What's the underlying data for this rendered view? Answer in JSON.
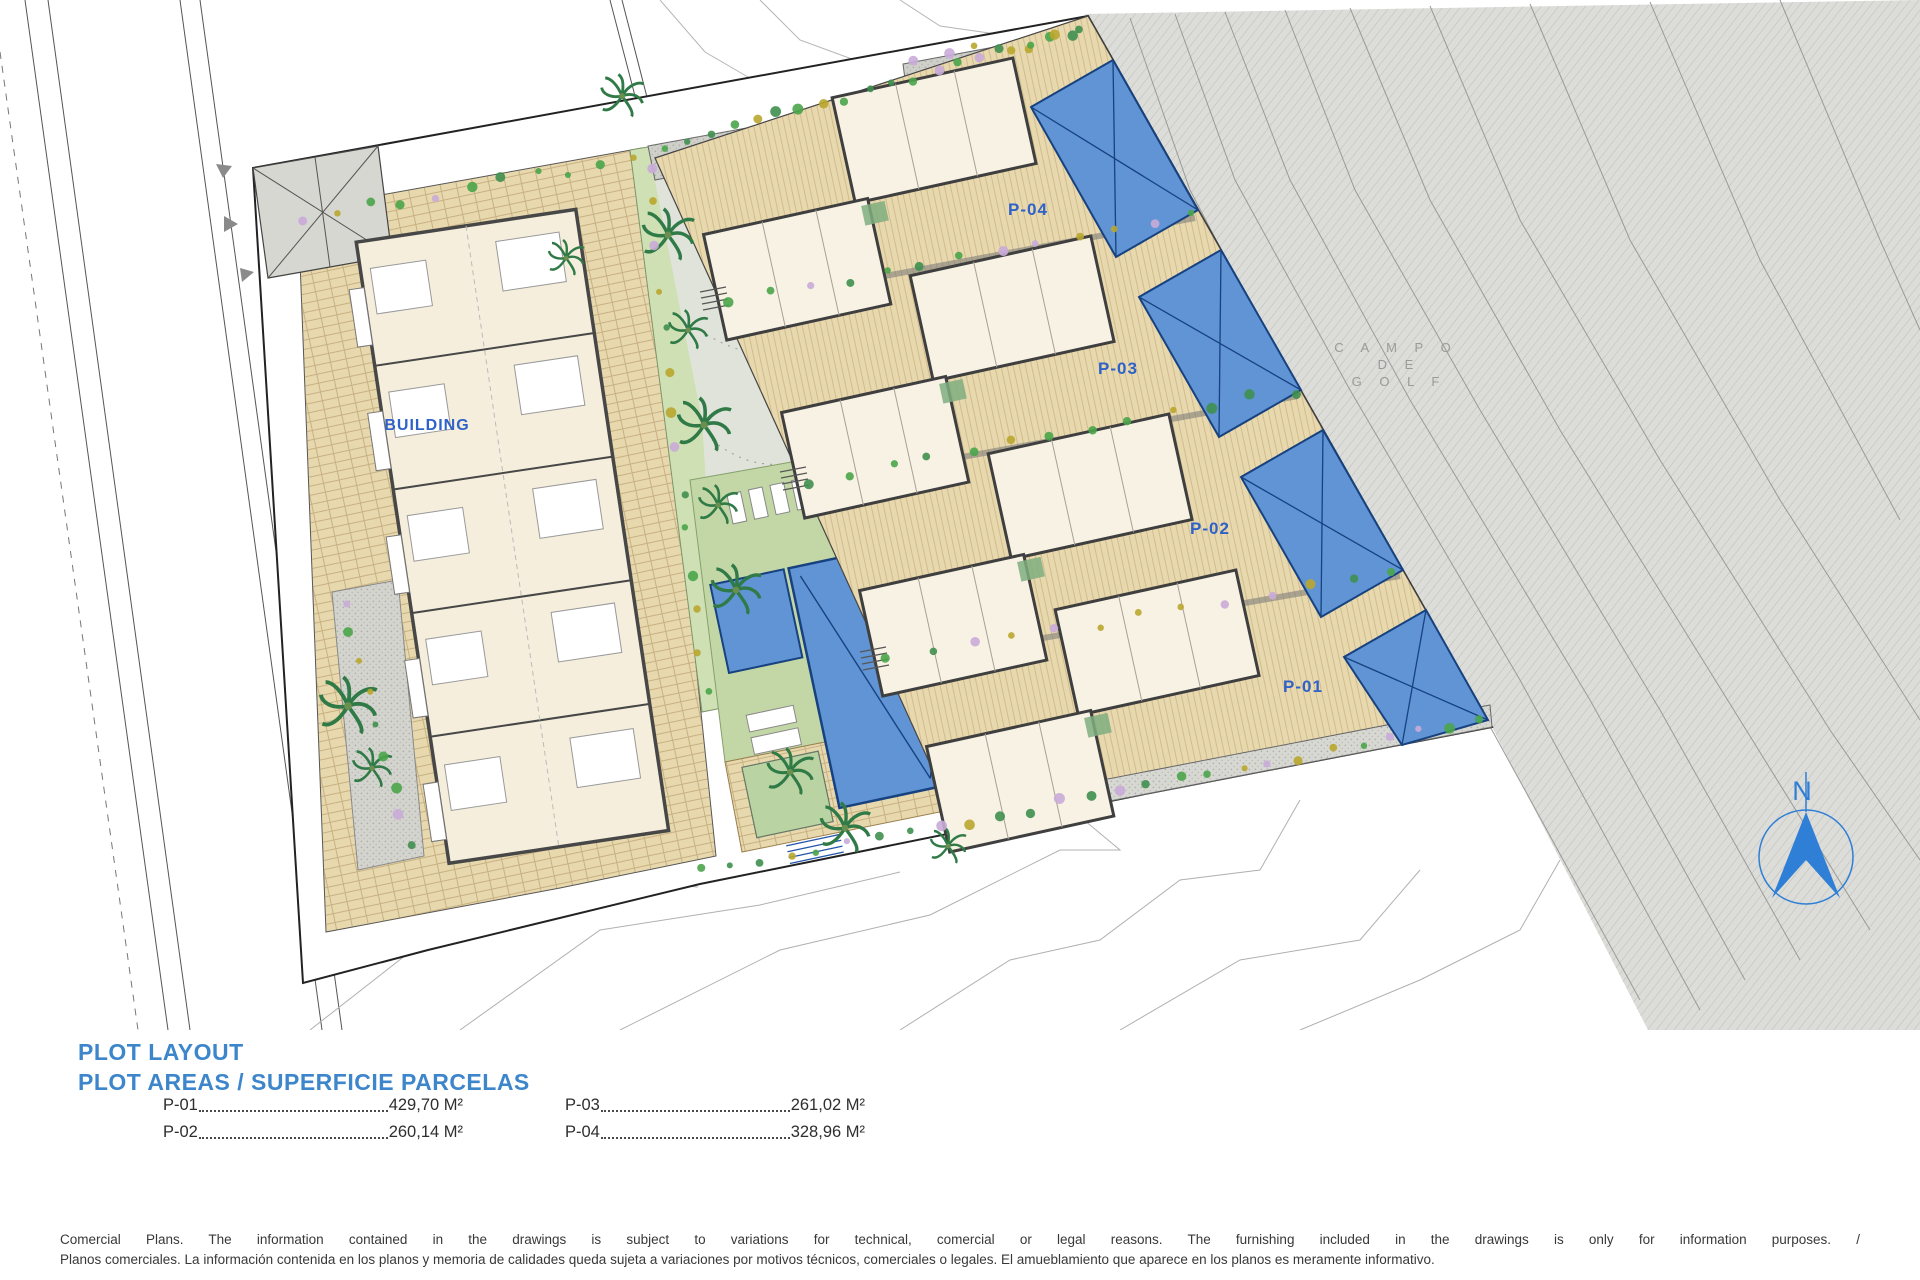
{
  "plan": {
    "labels": {
      "building": "BUILDING",
      "plot1": "P-01",
      "plot2": "P-02",
      "plot3": "P-03",
      "plot4": "P-04",
      "golf1": "C A M P O",
      "golf2": "D E",
      "golf3": "G O L F",
      "north": "N"
    },
    "colors": {
      "accent_blue": "#2e62c8",
      "heading_blue": "#3d86cb",
      "pool_blue": "#6094d4",
      "pool_border": "#17427f",
      "plot_tan": "#e8d8ae",
      "lawn_green": "#c3d7a6",
      "golf_gray": "#dcdcd8",
      "north_blue": "#2f7fd6"
    }
  },
  "legend": {
    "title": "PLOT LAYOUT",
    "subtitle": "PLOT AREAS / SUPERFICIE PARCELAS",
    "items": [
      {
        "label": "P-01",
        "value": "429,70 M²"
      },
      {
        "label": "P-02",
        "value": "260,14 M²"
      },
      {
        "label": "P-03",
        "value": "261,02 M²"
      },
      {
        "label": "P-04",
        "value": "328,96 M²"
      }
    ]
  },
  "disclaimer": {
    "line1": "Comercial Plans. The information contained in the drawings is subject to variations for technical, comercial or legal reasons. The furnishing included in the drawings is only for information purposes. /",
    "line2": "Planos comerciales. La información contenida en los planos y memoria de calidades queda sujeta a variaciones por motivos técnicos, comerciales o legales. El amueblamiento que aparece en los planos es meramente informativo."
  }
}
